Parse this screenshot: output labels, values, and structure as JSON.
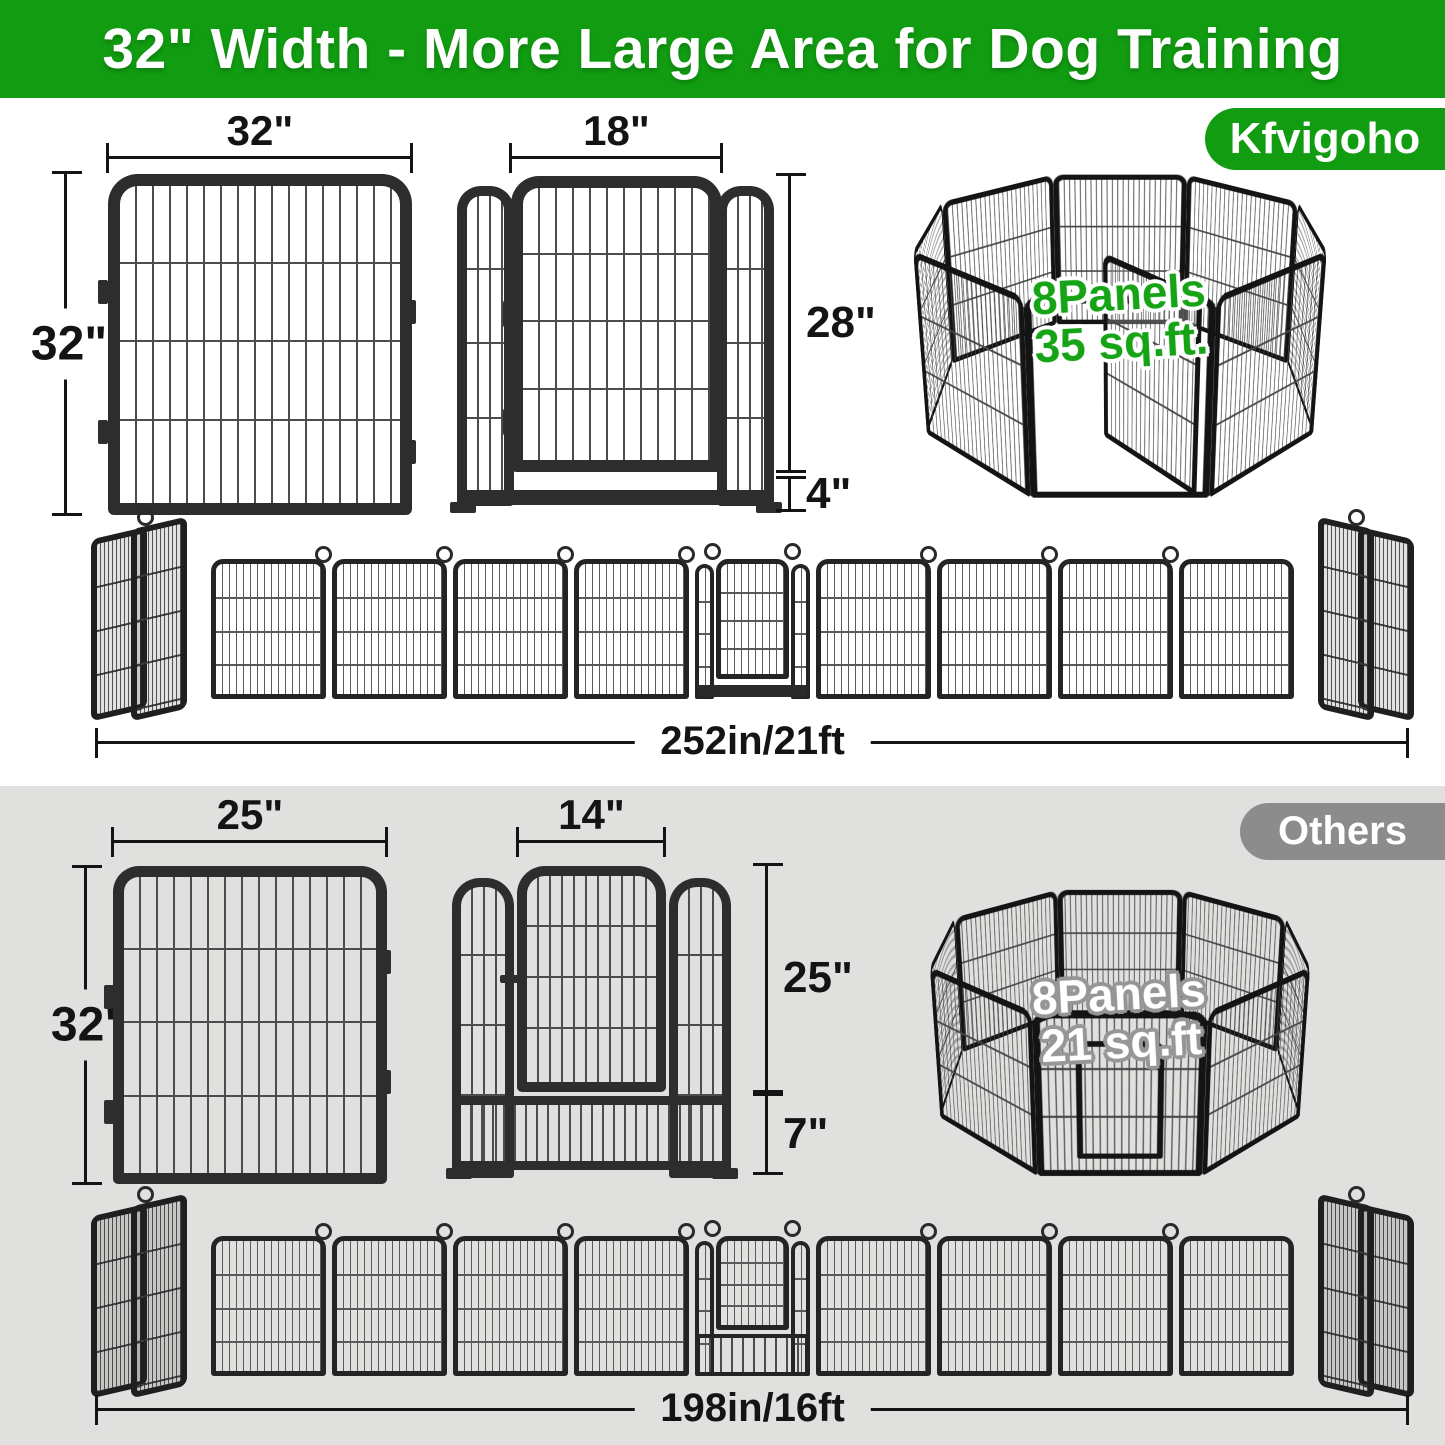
{
  "banner": {
    "title": "32\" Width - More Large Area for Dog Training"
  },
  "kfvigoho": {
    "badge": "Kfvigoho",
    "panel": {
      "width": "32\"",
      "height": "32\""
    },
    "door": {
      "width": "18\"",
      "height": "28\"",
      "ground_clearance": "4\""
    },
    "pen": {
      "line1": "8Panels",
      "line2": "35 sq.ft."
    },
    "row_length": "252in/21ft"
  },
  "others": {
    "badge": "Others",
    "panel": {
      "width": "25\"",
      "height": "32\""
    },
    "door": {
      "width": "14\"",
      "height": "25\"",
      "ground_clearance": "7\""
    },
    "pen": {
      "line1": "8Panels",
      "line2": "21 sq.ft"
    },
    "row_length": "198in/16ft"
  },
  "colors": {
    "brand_green": "#119C11",
    "pen_label_green": "#16A316",
    "badge_gray": "#8C8C8C",
    "section_gray": "#E0E0DE",
    "ink": "#141414",
    "frame_dark": "#2D2D2D"
  }
}
